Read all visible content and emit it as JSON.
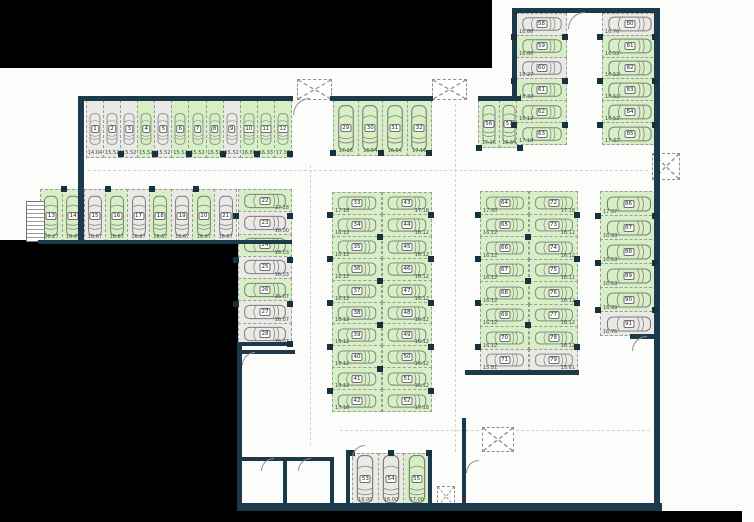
{
  "plan_title": "underground parking level plan",
  "legend": {
    "available_color": "#d6efc5",
    "occupied_color": "#ebe9e6",
    "wall_color": "#1d3a4b",
    "outside_color": "#000000"
  },
  "groups": [
    {
      "id": "row-1-12",
      "orientation": "v",
      "dim_side": "b",
      "spaces": [
        {
          "n": "1",
          "dim": "14.04",
          "status": "occupied"
        },
        {
          "n": "2",
          "dim": "15.52",
          "status": "occupied"
        },
        {
          "n": "3",
          "dim": "15.52",
          "status": "occupied"
        },
        {
          "n": "4",
          "dim": "15.52",
          "status": "available"
        },
        {
          "n": "5",
          "dim": "15.52",
          "status": "occupied"
        },
        {
          "n": "6",
          "dim": "15.52",
          "status": "available"
        },
        {
          "n": "7",
          "dim": "15.52",
          "status": "available"
        },
        {
          "n": "8",
          "dim": "15.52",
          "status": "available"
        },
        {
          "n": "9",
          "dim": "15.52",
          "status": "occupied"
        },
        {
          "n": "10",
          "dim": "16.86",
          "status": "available"
        },
        {
          "n": "11",
          "dim": "16.33",
          "status": "available"
        },
        {
          "n": "12",
          "dim": "17.37",
          "status": "available"
        }
      ]
    },
    {
      "id": "row-13-21",
      "orientation": "v",
      "dim_side": "b",
      "spaces": [
        {
          "n": "13",
          "dim": "20.27",
          "status": "available"
        },
        {
          "n": "14",
          "dim": "16.67",
          "status": "available"
        },
        {
          "n": "15",
          "dim": "16.67",
          "status": "occupied"
        },
        {
          "n": "16",
          "dim": "16.67",
          "status": "available"
        },
        {
          "n": "17",
          "dim": "16.67",
          "status": "occupied"
        },
        {
          "n": "18",
          "dim": "16.67",
          "status": "available"
        },
        {
          "n": "19",
          "dim": "16.67",
          "status": "occupied"
        },
        {
          "n": "20",
          "dim": "16.67",
          "status": "available"
        },
        {
          "n": "21",
          "dim": "16.67",
          "status": "occupied"
        }
      ]
    },
    {
      "id": "col-22-28",
      "orientation": "h",
      "dim_side": "br",
      "spaces": [
        {
          "n": "22",
          "dim": "17.18",
          "status": "available"
        },
        {
          "n": "23",
          "dim": "16.00",
          "status": "occupied"
        },
        {
          "n": "24",
          "dim": "16.03",
          "status": "available"
        },
        {
          "n": "25",
          "dim": "16.03",
          "status": "occupied"
        },
        {
          "n": "26",
          "dim": "16.07",
          "status": "available"
        },
        {
          "n": "27",
          "dim": "16.07",
          "status": "occupied"
        },
        {
          "n": "28",
          "dim": "16.07",
          "status": "occupied"
        }
      ]
    },
    {
      "id": "row-29-32",
      "orientation": "v",
      "dim_side": "b",
      "spaces": [
        {
          "n": "29",
          "dim": "17.16",
          "status": "available"
        },
        {
          "n": "30",
          "dim": "16.54",
          "status": "available"
        },
        {
          "n": "31",
          "dim": "16.54",
          "status": "available"
        },
        {
          "n": "32",
          "dim": "17.16",
          "status": "available"
        }
      ]
    },
    {
      "id": "col-33-42",
      "orientation": "h",
      "dim_side": "bl",
      "spaces": [
        {
          "n": "33",
          "dim": "17.18",
          "status": "available"
        },
        {
          "n": "34",
          "dim": "16.12",
          "status": "available"
        },
        {
          "n": "35",
          "dim": "16.12",
          "status": "available"
        },
        {
          "n": "36",
          "dim": "16.12",
          "status": "available"
        },
        {
          "n": "37",
          "dim": "16.12",
          "status": "available"
        },
        {
          "n": "38",
          "dim": "16.12",
          "status": "available"
        },
        {
          "n": "39",
          "dim": "16.12",
          "status": "available"
        },
        {
          "n": "40",
          "dim": "16.12",
          "status": "available"
        },
        {
          "n": "41",
          "dim": "16.12",
          "status": "available"
        },
        {
          "n": "42",
          "dim": "17.18",
          "status": "available"
        }
      ]
    },
    {
      "id": "col-43-52",
      "orientation": "h",
      "dim_side": "br",
      "spaces": [
        {
          "n": "43",
          "dim": "17.18",
          "status": "available"
        },
        {
          "n": "44",
          "dim": "16.12",
          "status": "available"
        },
        {
          "n": "45",
          "dim": "16.12",
          "status": "available"
        },
        {
          "n": "46",
          "dim": "16.12",
          "status": "available"
        },
        {
          "n": "47",
          "dim": "16.12",
          "status": "available"
        },
        {
          "n": "48",
          "dim": "16.12",
          "status": "available"
        },
        {
          "n": "49",
          "dim": "16.12",
          "status": "available"
        },
        {
          "n": "50",
          "dim": "16.12",
          "status": "available"
        },
        {
          "n": "51",
          "dim": "16.12",
          "status": "available"
        },
        {
          "n": "52",
          "dim": "17.18",
          "status": "available"
        }
      ]
    },
    {
      "id": "row-53-55",
      "orientation": "v",
      "dim_side": "b",
      "spaces": [
        {
          "n": "53",
          "dim": "16.00",
          "status": "occupied"
        },
        {
          "n": "54",
          "dim": "16.00",
          "status": "occupied"
        },
        {
          "n": "55",
          "dim": "17.00",
          "status": "available"
        }
      ]
    },
    {
      "id": "row-56-57",
      "orientation": "v",
      "dim_side": "b",
      "spaces": [
        {
          "n": "56",
          "dim": "17.16",
          "status": "available"
        },
        {
          "n": "57",
          "dim": "16.54",
          "status": "available"
        }
      ]
    },
    {
      "id": "col-58-63",
      "orientation": "h",
      "dim_side": "bl",
      "spaces": [
        {
          "n": "58",
          "dim": "16.66",
          "status": "occupied"
        },
        {
          "n": "59",
          "dim": "16.66",
          "status": "available"
        },
        {
          "n": "60",
          "dim": "16.27",
          "status": "occupied"
        },
        {
          "n": "61",
          "dim": "16.33",
          "status": "available"
        },
        {
          "n": "62",
          "dim": "16.12",
          "status": "available"
        },
        {
          "n": "63",
          "dim": "17.18",
          "status": "available"
        }
      ]
    },
    {
      "id": "col-64-71",
      "orientation": "h",
      "dim_side": "bl",
      "spaces": [
        {
          "n": "64",
          "dim": "17.00",
          "status": "available"
        },
        {
          "n": "65",
          "dim": "16.12",
          "status": "available"
        },
        {
          "n": "66",
          "dim": "16.12",
          "status": "available"
        },
        {
          "n": "67",
          "dim": "16.12",
          "status": "available"
        },
        {
          "n": "68",
          "dim": "16.12",
          "status": "available"
        },
        {
          "n": "69",
          "dim": "16.12",
          "status": "available"
        },
        {
          "n": "70",
          "dim": "16.12",
          "status": "available"
        },
        {
          "n": "71",
          "dim": "15.81",
          "status": "occupied"
        }
      ]
    },
    {
      "id": "col-72-79",
      "orientation": "h",
      "dim_side": "br",
      "spaces": [
        {
          "n": "72",
          "dim": "17.18",
          "status": "available"
        },
        {
          "n": "73",
          "dim": "16.12",
          "status": "available"
        },
        {
          "n": "74",
          "dim": "16.12",
          "status": "available"
        },
        {
          "n": "75",
          "dim": "16.12",
          "status": "available"
        },
        {
          "n": "76",
          "dim": "16.12",
          "status": "available"
        },
        {
          "n": "77",
          "dim": "16.12",
          "status": "available"
        },
        {
          "n": "78",
          "dim": "16.12",
          "status": "available"
        },
        {
          "n": "79",
          "dim": "15.81",
          "status": "occupied"
        }
      ]
    },
    {
      "id": "col-80-85",
      "orientation": "h",
      "dim_side": "bl",
      "spaces": [
        {
          "n": "80",
          "dim": "16.76",
          "status": "occupied"
        },
        {
          "n": "81",
          "dim": "16.53",
          "status": "available"
        },
        {
          "n": "82",
          "dim": "16.53",
          "status": "available"
        },
        {
          "n": "83",
          "dim": "16.53",
          "status": "available"
        },
        {
          "n": "84",
          "dim": "16.53",
          "status": "available"
        },
        {
          "n": "85",
          "dim": "17.37",
          "status": "available"
        }
      ]
    },
    {
      "id": "col-86-91",
      "orientation": "h",
      "dim_side": "bl",
      "spaces": [
        {
          "n": "86",
          "dim": "17.37",
          "status": "available"
        },
        {
          "n": "87",
          "dim": "16.33",
          "status": "available"
        },
        {
          "n": "88",
          "dim": "16.53",
          "status": "available"
        },
        {
          "n": "89",
          "dim": "16.53",
          "status": "available"
        },
        {
          "n": "90",
          "dim": "16.39",
          "status": "available"
        },
        {
          "n": "91",
          "dim": "16.76",
          "status": "occupied"
        }
      ]
    }
  ]
}
